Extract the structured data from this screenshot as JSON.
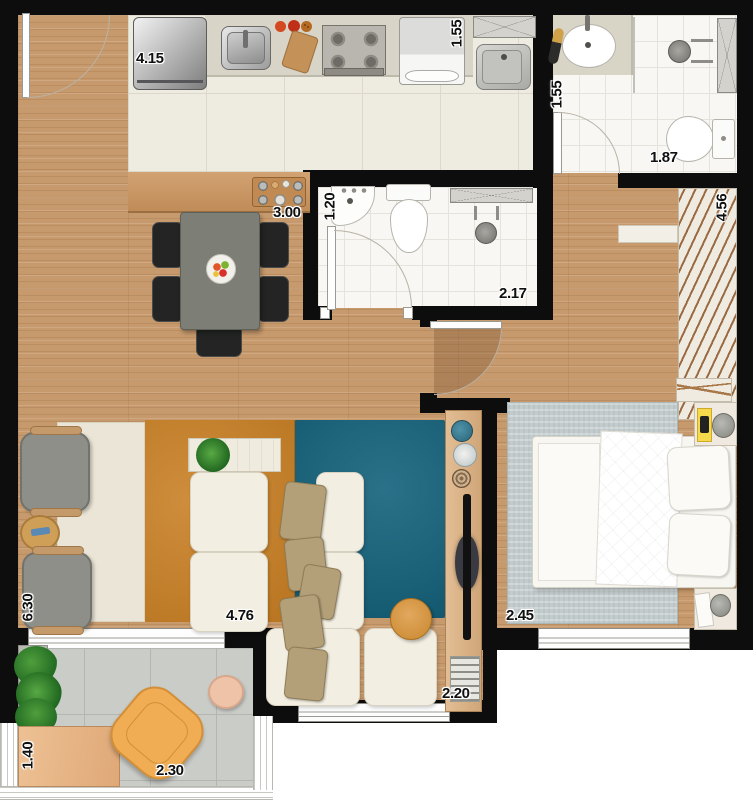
{
  "plan": {
    "labels": [
      {
        "id": "kitchen-width",
        "text": "4.15",
        "orientation": "horizontal"
      },
      {
        "id": "laundry-width",
        "text": "1.55",
        "orientation": "vertical"
      },
      {
        "id": "bathroom1-width",
        "text": "1.55",
        "orientation": "vertical"
      },
      {
        "id": "bathroom1-length",
        "text": "1.87",
        "orientation": "horizontal"
      },
      {
        "id": "counter-length",
        "text": "3.00",
        "orientation": "horizontal"
      },
      {
        "id": "bathroom2-width",
        "text": "1.20",
        "orientation": "vertical"
      },
      {
        "id": "bathroom2-length",
        "text": "2.17",
        "orientation": "horizontal"
      },
      {
        "id": "closet-length",
        "text": "4.56",
        "orientation": "vertical"
      },
      {
        "id": "living-length",
        "text": "6.30",
        "orientation": "vertical"
      },
      {
        "id": "living-width",
        "text": "4.76",
        "orientation": "horizontal"
      },
      {
        "id": "bedroom-width",
        "text": "2.45",
        "orientation": "horizontal"
      },
      {
        "id": "tv-wall-length",
        "text": "2.20",
        "orientation": "horizontal"
      },
      {
        "id": "balcony-depth",
        "text": "1.40",
        "orientation": "vertical"
      },
      {
        "id": "balcony-length",
        "text": "2.30",
        "orizontal": "horizontal"
      }
    ],
    "colors": {
      "wall": "#0d0d0d",
      "wood_floor": "#c79a6d",
      "kitchen_tile": "#eeebe1",
      "bathroom_tile": "#f8f7f3",
      "balcony_tile": "#caccc8",
      "teal_rug": "#12617b",
      "orange_rug": "#c87e22",
      "cream_rug": "#eae5d6",
      "sofa": "#f2eee2",
      "pillow_tan": "#b3a078",
      "ottoman_orange": "#d89a4b",
      "armchair_gray": "#8f8f89",
      "balcony_chair_yellow": "#f0ad53",
      "bedroom_rug": "#c3cccd",
      "counter_wood": "#c9935e",
      "dining_table_gray": "#7d7f77",
      "dining_chair_black": "#232423"
    }
  }
}
